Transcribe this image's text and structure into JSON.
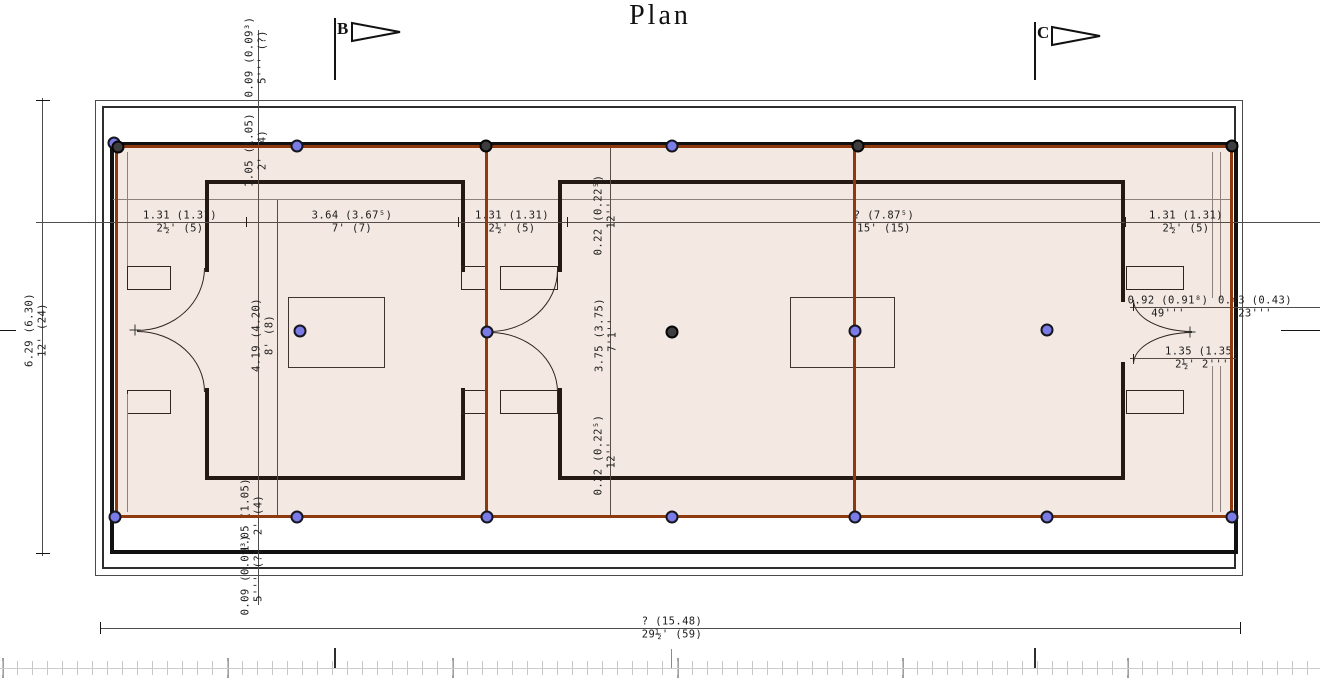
{
  "title": "Plan",
  "section_markers": {
    "b": "B",
    "c": "C"
  },
  "dims": [
    {
      "id": "top-margin",
      "metric": "0.09 (0.09³)",
      "imperial": "5''' (?)"
    },
    {
      "id": "top-offset",
      "metric": "1.05 (1.05)",
      "imperial": "2' (4)"
    },
    {
      "id": "total-height",
      "metric": "6.29 (6.30)",
      "imperial": "12' (24)"
    },
    {
      "id": "wall-left",
      "metric": "1.31 (1.31)",
      "imperial": "2½' (5)"
    },
    {
      "id": "room1-width",
      "metric": "3.64 (3.67⁵)",
      "imperial": "7' (7)"
    },
    {
      "id": "wall-mid",
      "metric": "1.31 (1.31)",
      "imperial": "2½' (5)"
    },
    {
      "id": "room2-width",
      "metric": "? (7.87⁵)",
      "imperial": "15' (15)"
    },
    {
      "id": "wall-right",
      "metric": "1.31 (1.31)",
      "imperial": "2½' (5)"
    },
    {
      "id": "wall-top-thick",
      "metric": "0.22 (0.22⁵)",
      "imperial": "12''"
    },
    {
      "id": "room1-depth",
      "metric": "4.19 (4.20)",
      "imperial": "8' (8)"
    },
    {
      "id": "room2-depth",
      "metric": "3.75 (3.75)",
      "imperial": "7'1''"
    },
    {
      "id": "wall-bottom-thick",
      "metric": "0.22 (0.22⁵)",
      "imperial": "12''"
    },
    {
      "id": "door-jamb-a",
      "metric": "0.92 (0.91⁸)",
      "imperial": "49'''"
    },
    {
      "id": "door-jamb-b",
      "metric": "0.43 (0.43)",
      "imperial": "23'''"
    },
    {
      "id": "door-width",
      "metric": "1.35 (1.35)",
      "imperial": "2½' 2'''"
    },
    {
      "id": "bottom-offset",
      "metric": "1.05 (1.05)",
      "imperial": "2' (4)"
    },
    {
      "id": "bottom-margin",
      "metric": "0.09 (0.09³)",
      "imperial": "5''' (?)"
    },
    {
      "id": "total-width",
      "metric": "? (15.48)",
      "imperial": "29½' (59)"
    }
  ],
  "colors": {
    "overlay_line": "#8f3a0e",
    "overlay_fill": "rgba(155,62,20,0.12)",
    "dot_blue": "#7b7be8",
    "dot_dark": "#3d3d40"
  },
  "overlay": {
    "dots": [
      {
        "x": 114,
        "y": 143,
        "color": "blue"
      },
      {
        "x": 118,
        "y": 147,
        "color": "dark"
      },
      {
        "x": 297,
        "y": 146,
        "color": "blue"
      },
      {
        "x": 486,
        "y": 146,
        "color": "dark"
      },
      {
        "x": 672,
        "y": 146,
        "color": "blue"
      },
      {
        "x": 858,
        "y": 146,
        "color": "dark"
      },
      {
        "x": 1232,
        "y": 146,
        "color": "dark"
      },
      {
        "x": 300,
        "y": 331,
        "color": "blue"
      },
      {
        "x": 487,
        "y": 332,
        "color": "blue"
      },
      {
        "x": 672,
        "y": 332,
        "color": "dark"
      },
      {
        "x": 855,
        "y": 331,
        "color": "blue"
      },
      {
        "x": 1047,
        "y": 330,
        "color": "blue"
      },
      {
        "x": 115,
        "y": 517,
        "color": "blue"
      },
      {
        "x": 297,
        "y": 517,
        "color": "blue"
      },
      {
        "x": 487,
        "y": 517,
        "color": "blue"
      },
      {
        "x": 672,
        "y": 517,
        "color": "blue"
      },
      {
        "x": 855,
        "y": 517,
        "color": "blue"
      },
      {
        "x": 1047,
        "y": 517,
        "color": "blue"
      },
      {
        "x": 1232,
        "y": 517,
        "color": "blue"
      }
    ]
  }
}
